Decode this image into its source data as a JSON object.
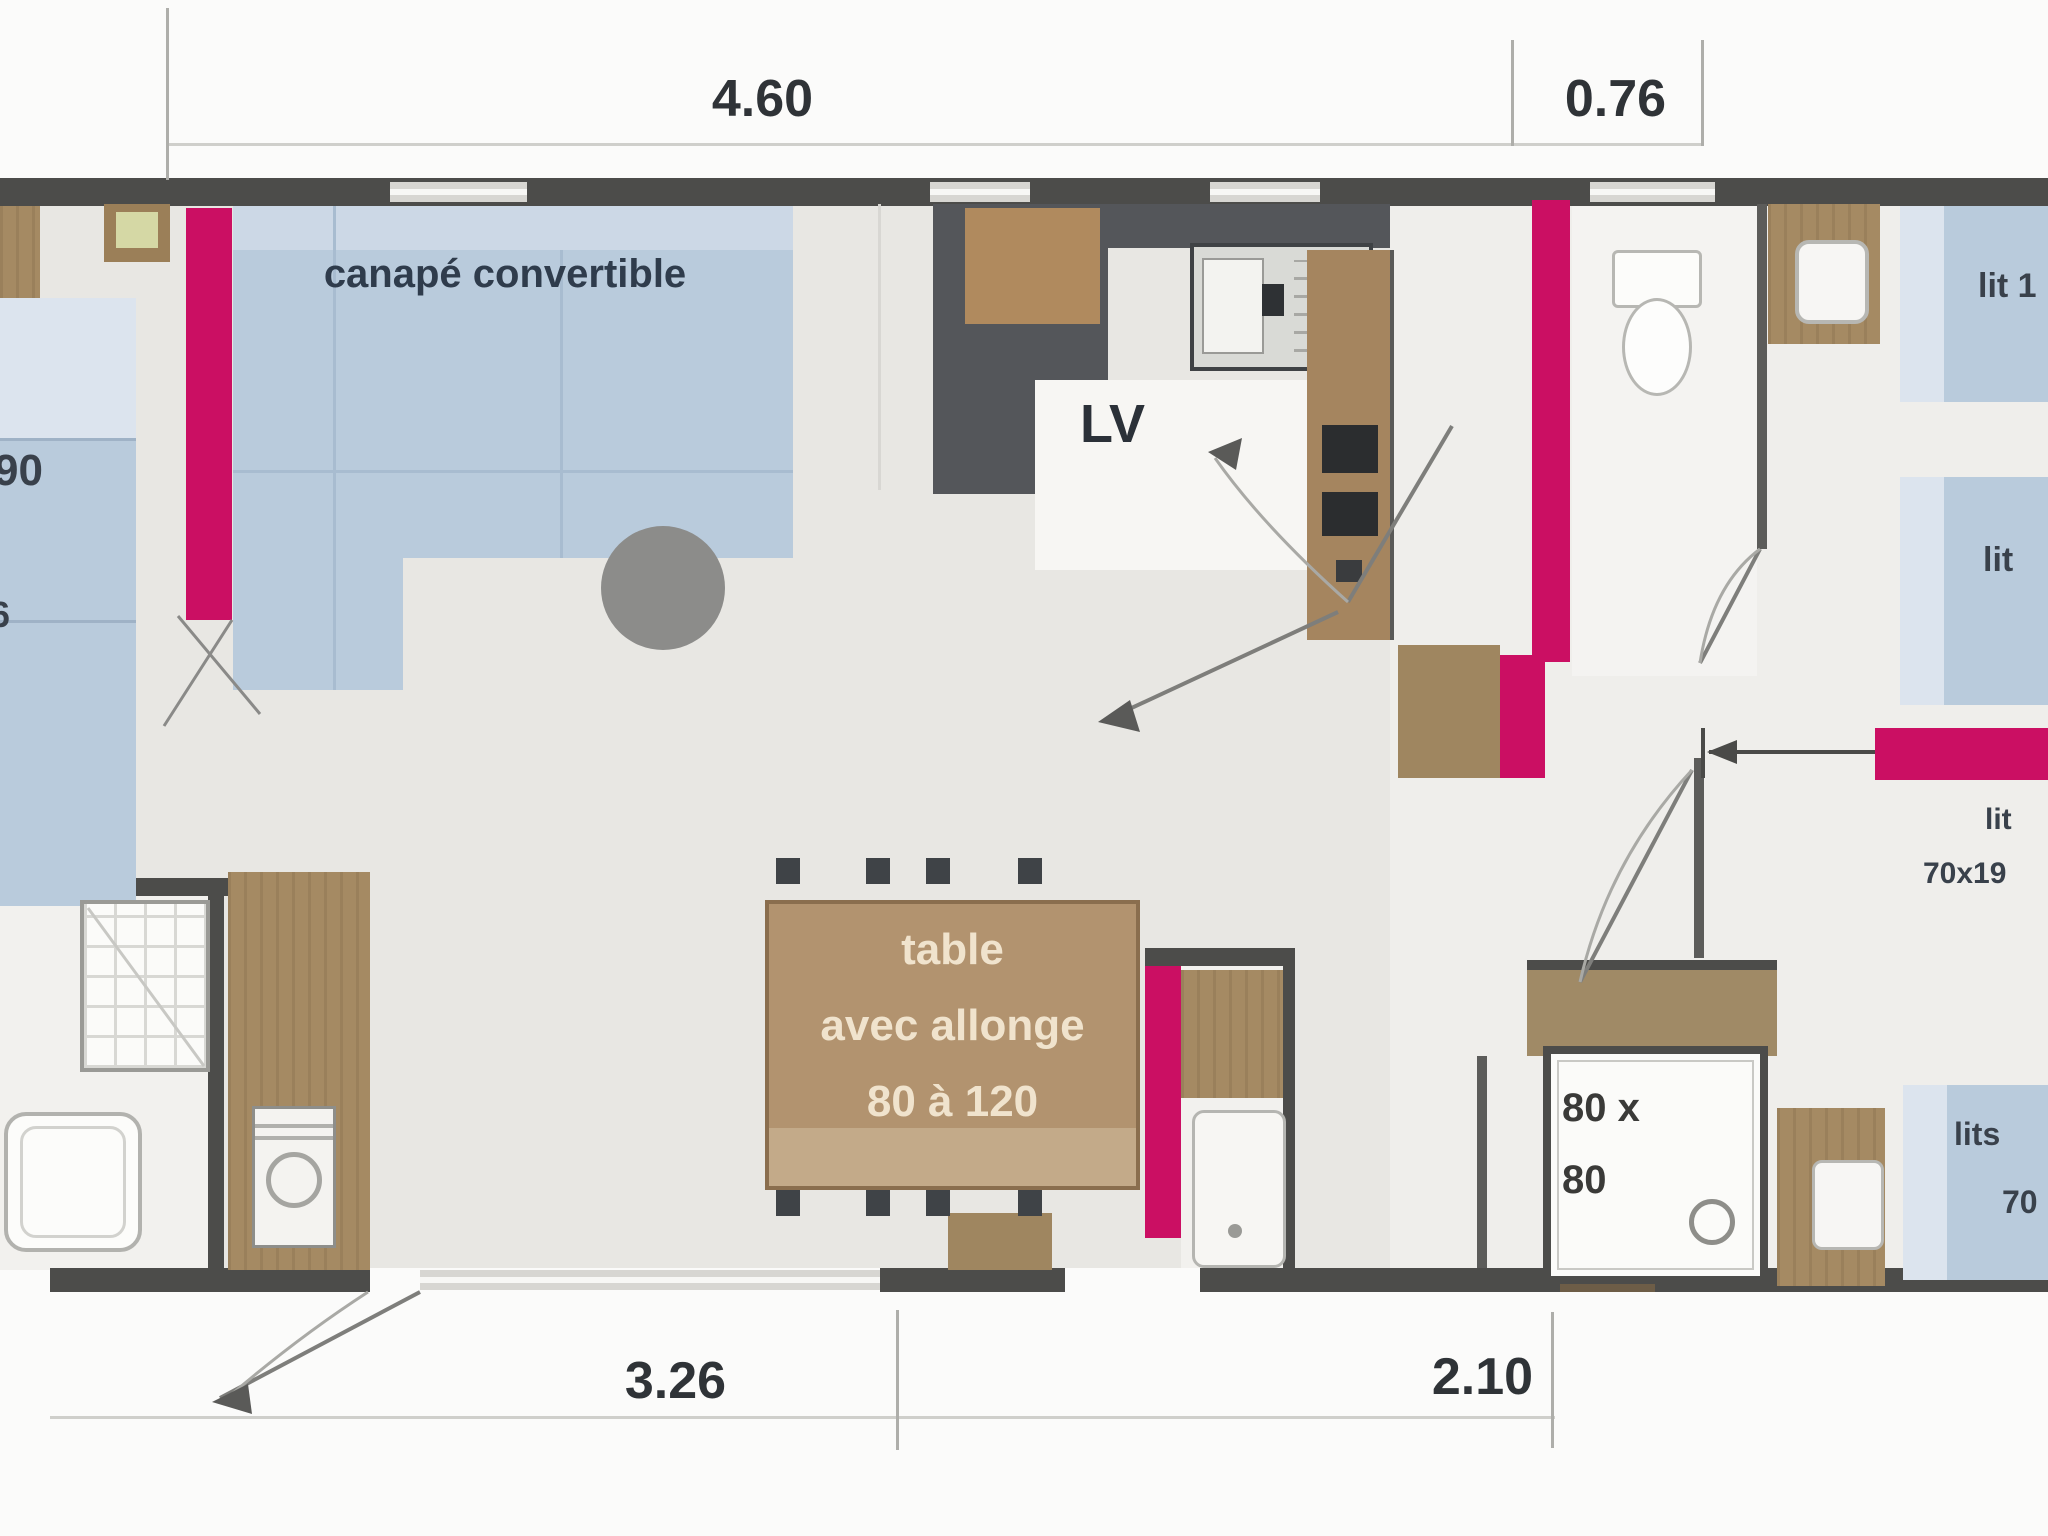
{
  "dimensions": {
    "top": [
      "4.60",
      "0.76"
    ],
    "bottom": [
      "3.26",
      "2.10"
    ]
  },
  "labels": {
    "sofa": "canapé convertible",
    "dishwasher": "LV",
    "table": [
      "table",
      "avec allonge",
      "80 à 120"
    ],
    "shower": [
      "80 x",
      "80"
    ],
    "bed_top_right": "lit 1",
    "bed_mid_right": "lit",
    "bed_note": [
      "lit",
      "70x19"
    ],
    "bed_bottom_right": [
      "lits",
      "70"
    ],
    "bed_left": [
      "90",
      "6"
    ]
  },
  "icons": {
    "burner": "✳"
  },
  "colors": {
    "accent_pink": "#cb0f63",
    "wood": "#a58a63",
    "bed_blue": "#b9cbdc",
    "wall_dark": "#4c4c4a",
    "counter_dark": "#54565a",
    "floor": "#e8e7e3"
  }
}
